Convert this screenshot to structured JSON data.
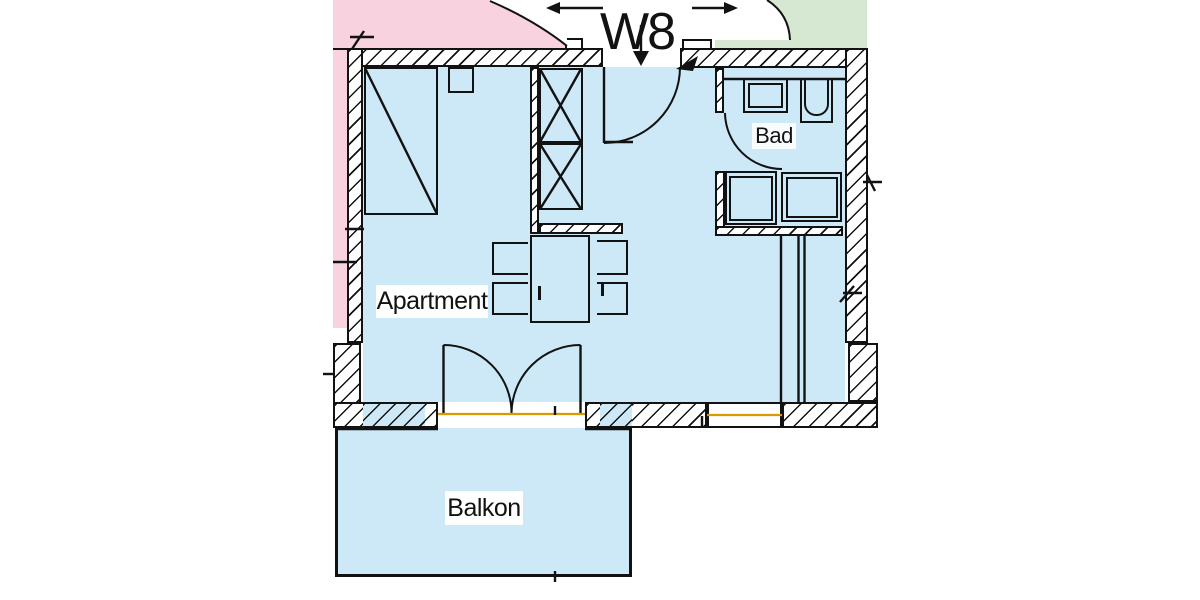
{
  "unit_label": "W8",
  "rooms": [
    {
      "name": "Apartment"
    },
    {
      "name": "Bad"
    },
    {
      "name": "Balkon"
    }
  ],
  "colors": {
    "interior": "#cde8f6",
    "neighbor-left": "#f8d3df",
    "neighbor-right": "#d6e8d2",
    "threshold": "#d79b00",
    "ink": "#121212",
    "wall-bg": "#ffffff"
  }
}
